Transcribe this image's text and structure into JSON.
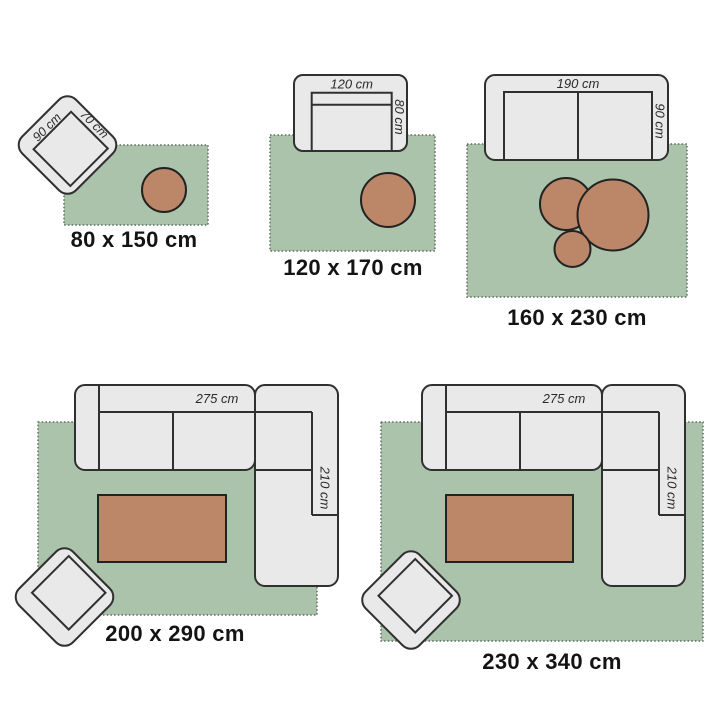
{
  "title": "rug size comparison guide",
  "colors": {
    "background": "#ffffff",
    "rug_fill": "#abc3ab",
    "rug_border": "#5c6b5e",
    "furniture_fill": "#e9e9e9",
    "furniture_border": "#303030",
    "accent_brown": "#bc8669",
    "brown_border": "#222222",
    "text": "#141414",
    "dim_text": "#2a2a2a"
  },
  "diagrams": [
    {
      "name": "rug-80x150",
      "size_label": "80 x 150 cm",
      "furniture": {
        "type": "armchair rotated 45deg with round side table",
        "width_label": "90 cm",
        "depth_label": "70 cm"
      }
    },
    {
      "name": "rug-120x170",
      "size_label": "120 x 170 cm",
      "furniture": {
        "type": "single sofa with round side table",
        "width_label": "120 cm",
        "depth_label": "80 cm"
      }
    },
    {
      "name": "rug-160x230",
      "size_label": "160 x 230 cm",
      "furniture": {
        "type": "two-seat sofa with three round nesting tables",
        "width_label": "190 cm",
        "depth_label": "90 cm"
      }
    },
    {
      "name": "rug-200x290",
      "size_label": "200 x 290 cm",
      "furniture": {
        "type": "corner sofa with coffee table and armchair",
        "width_label": "275 cm",
        "depth_label": "210 cm"
      }
    },
    {
      "name": "rug-230x340",
      "size_label": "230 x 340 cm",
      "furniture": {
        "type": "corner sofa with coffee table and armchair",
        "width_label": "275 cm",
        "depth_label": "210 cm"
      }
    }
  ]
}
